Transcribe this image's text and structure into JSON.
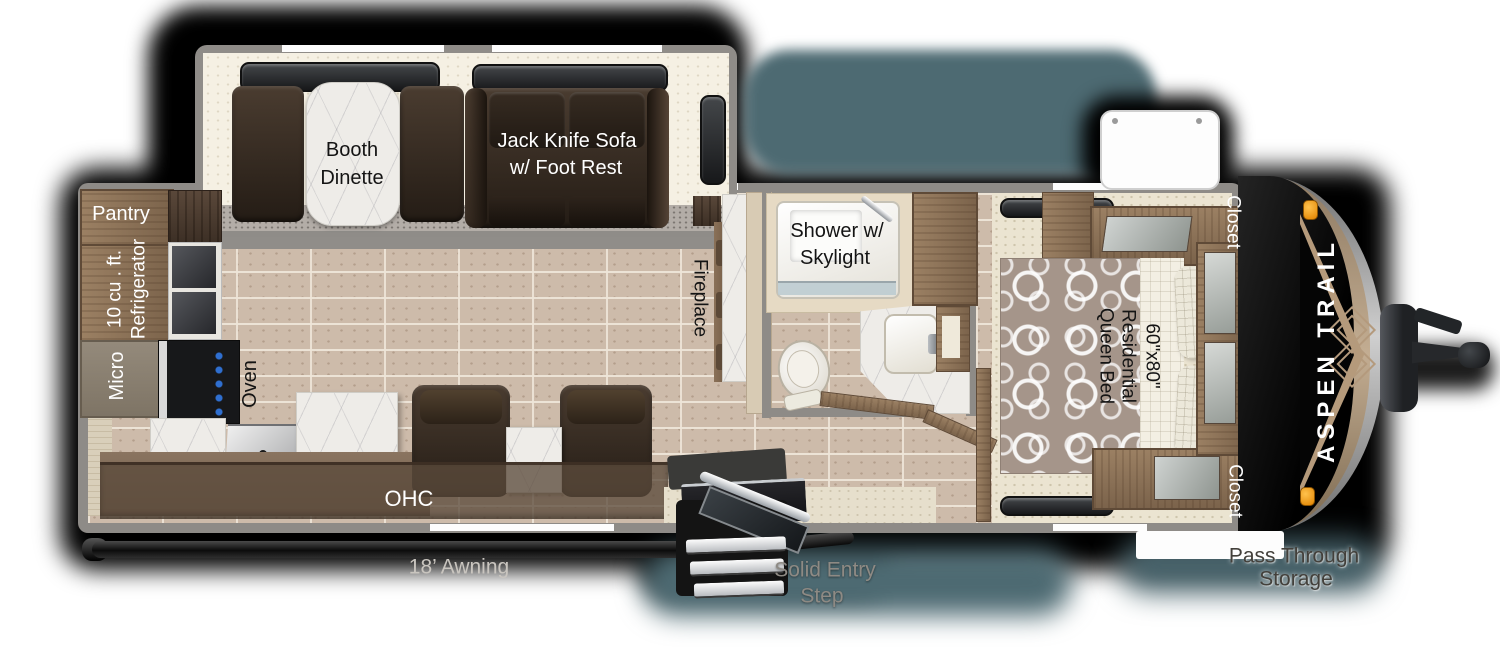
{
  "brand": {
    "logo": "ASPEN TRAIL"
  },
  "slide_out": {
    "dinette_1": "Booth",
    "dinette_2": "Dinette",
    "sofa_1": "Jack Knife Sofa",
    "sofa_2": "w/ Foot Rest"
  },
  "kitchen": {
    "pantry": "Pantry",
    "fridge_1": "10 cu . ft.",
    "fridge_2": "Refrigerator",
    "micro": "Micro",
    "oven": "Oven",
    "ohc": "OHC"
  },
  "living": {
    "fireplace": "Fireplace"
  },
  "bathroom": {
    "shower_1": "Shower w/",
    "shower_2": "Skylight"
  },
  "bedroom": {
    "bed_size": "60\"x80\"",
    "bed_1": "Residential",
    "bed_2": "Queen Bed",
    "closet_top": "Closet",
    "closet_bottom": "Closet"
  },
  "exterior": {
    "awning": "18’ Awning",
    "entry_1": "Solid Entry",
    "entry_2": "Step",
    "pass_1": "Pass Through",
    "pass_2": "Storage"
  },
  "colors": {
    "wall_gray": "#8e8b87",
    "floor_tile": "#cdbbaa",
    "carpet_cream": "#ebe4d1",
    "wood": "#8d7257",
    "dark_wood": "#4a3a2e",
    "sofa_brown": "#3a2f26",
    "marble": "#eeece8",
    "cap_black": "#141414",
    "cap_tan": "#b49a7d",
    "marker_orange": "#f39a15",
    "shadow_teal": "#4d6a72"
  }
}
